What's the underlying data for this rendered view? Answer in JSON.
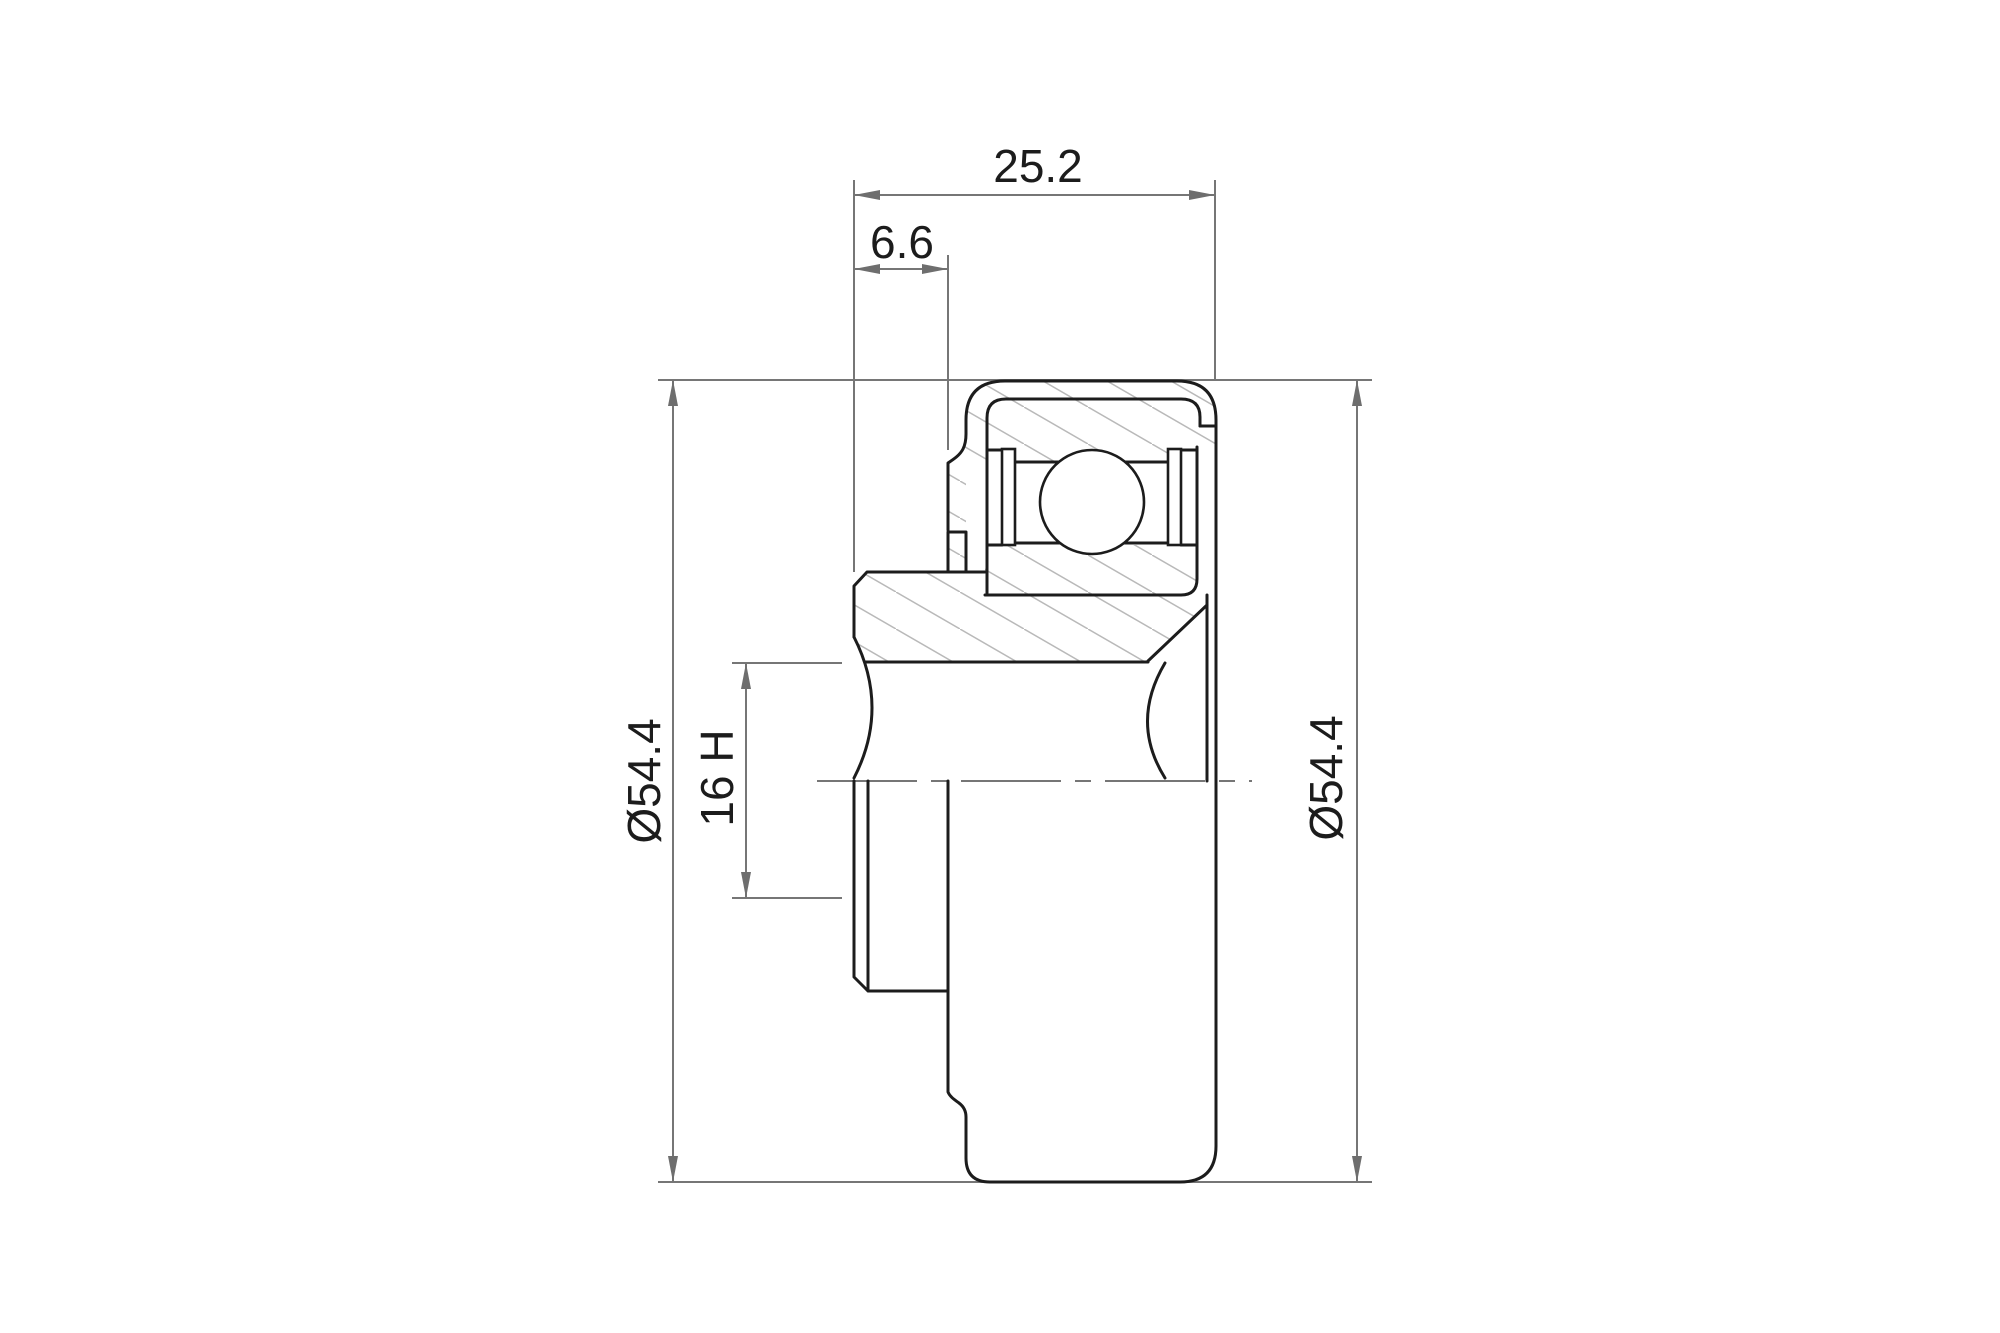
{
  "drawing": {
    "labels": {
      "total_width": "25.2",
      "flange_offset": "6.6",
      "outer_diameter_left": "Ø54.4",
      "outer_diameter_right": "Ø54.4",
      "bore_diameter": "16 H"
    },
    "colors": {
      "outline": "#1c1c1c",
      "dimension_line": "#767676",
      "arrow": "#6e6e6e",
      "hatch": "#b9b9b9",
      "background": "#ffffff",
      "text": "#1c1c1c"
    }
  }
}
